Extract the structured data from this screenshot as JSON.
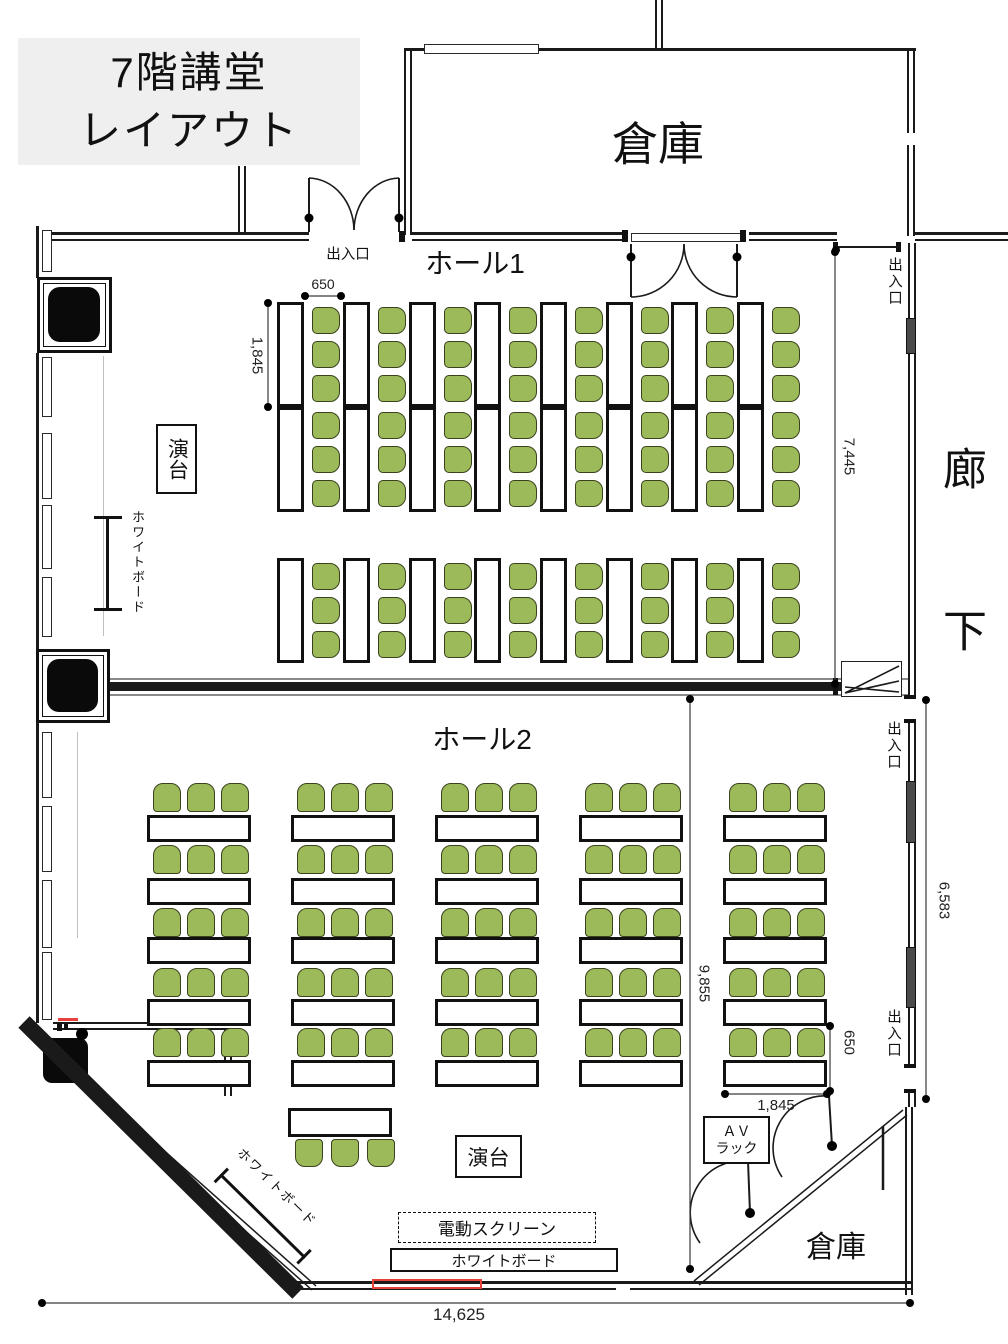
{
  "title": {
    "line1": "7階講堂",
    "line2": "レイアウト"
  },
  "rooms": {
    "hall1": "ホール1",
    "hall2": "ホール2",
    "storage_top": "倉庫",
    "storage_bottom": "倉庫",
    "corridor": "廊下"
  },
  "labels": {
    "exit": "出入口",
    "podium": "演台",
    "whiteboard": "ホワイトボード",
    "electric_screen": "電動スクリーン",
    "av_rack_line1": "ＡＶ",
    "av_rack_line2": "ラック"
  },
  "dimensions": {
    "chair_pitch_top": "650",
    "table_length_left": "1,845",
    "hall1_depth": "7,445",
    "corridor_side": "6,583",
    "hall2_depth": "9,855",
    "chair_pitch_right": "650",
    "table_length_bottom": "1,845",
    "room_width": "14,625"
  },
  "furniture": {
    "hall1": {
      "columns": 8,
      "front_tables_per_column": 2,
      "back_tables_per_column": 1,
      "chairs_per_table": 3
    },
    "hall2": {
      "groups": 5,
      "table_rows_per_group": 5,
      "chairs_per_table": 3,
      "head_table_chairs": 3
    }
  },
  "colors": {
    "chair_fill": "#9CBA5A",
    "chair_stroke": "#3F4D20",
    "wall": "#1A1A1A",
    "dimension": "#3A3A3A",
    "accent_red": "#E8413C",
    "title_bg": "#EFEFEF"
  }
}
